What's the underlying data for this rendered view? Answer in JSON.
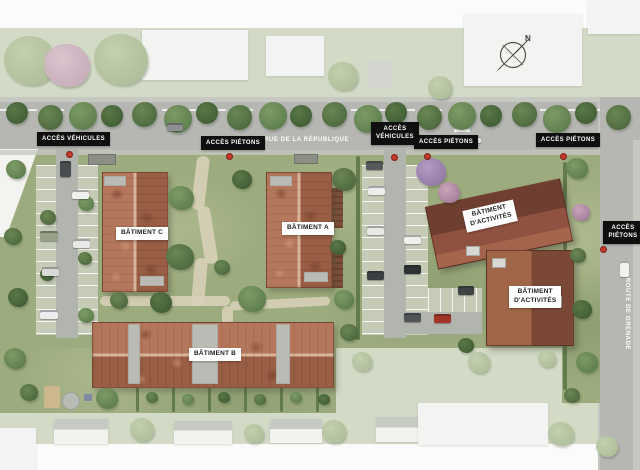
{
  "plan": {
    "streets": {
      "main_road": "RUE DE LA RÉPUBLIQUE",
      "side_road": "ROUTE DE GRENADE"
    },
    "compass_north": "N",
    "access": {
      "vehicles_west": "ACCÈS VÉHICULES",
      "pedestrians_west": "ACCÈS PIÉTONS",
      "vehicles_center": {
        "line1": "ACCÈS",
        "line2": "VÉHICULES"
      },
      "pedestrians_center": "ACCÈS PIÉTONS",
      "pedestrians_east": "ACCÈS PIÉTONS",
      "pedestrians_side_road": {
        "line1": "ACCÈS",
        "line2": "PIÉTONS"
      }
    },
    "buildings": {
      "batiment_a": "BÂTIMENT A",
      "batiment_b": "BÂTIMENT B",
      "batiment_c": "BÂTIMENT C",
      "activity_north": {
        "line1": "BÂTIMENT",
        "line2": "D'ACTIVITÉS"
      },
      "activity_south": {
        "line1": "BÂTIMENT",
        "line2": "D'ACTIVITÉS"
      }
    },
    "colors": {
      "access_label_bg": "#0f0f0f",
      "access_label_text": "#ffffff",
      "building_label_bg": "#ffffff",
      "building_label_text": "#1e1e1c",
      "road": "#b6b7b3",
      "lawn": "#9dac7e",
      "residential_roof": "#a8694d",
      "activity_roof": "#7c4434",
      "access_pin": "#c23a2c"
    }
  }
}
